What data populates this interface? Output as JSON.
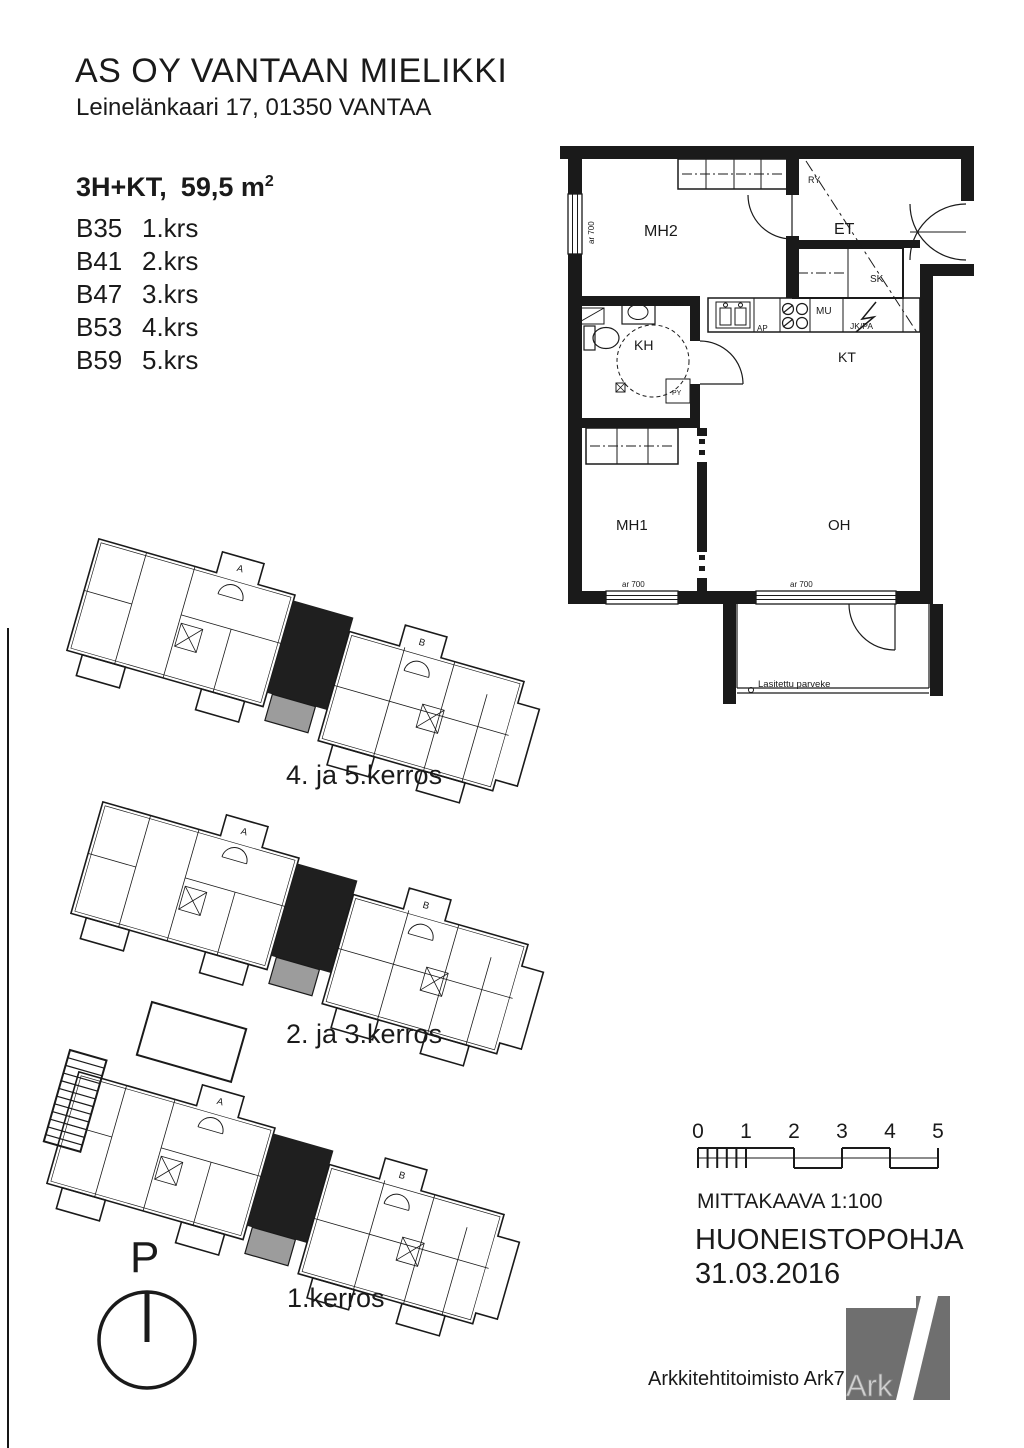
{
  "header": {
    "title": "AS OY VANTAAN MIELIKKI",
    "address": "Leinelänkaari 17, 01350  VANTAA"
  },
  "apartment": {
    "type": "3H+KT,",
    "area": "59,5 m",
    "area_sup": "2",
    "units": [
      {
        "id": "B35",
        "floor": "1.krs"
      },
      {
        "id": "B41",
        "floor": "2.krs"
      },
      {
        "id": "B47",
        "floor": "3.krs"
      },
      {
        "id": "B53",
        "floor": "4.krs"
      },
      {
        "id": "B59",
        "floor": "5.krs"
      }
    ]
  },
  "floorplan": {
    "rooms": {
      "mh2": "MH2",
      "et": "ET",
      "kh": "KH",
      "kt": "KT",
      "mh1": "MH1",
      "oh": "OH"
    },
    "fixtures": {
      "sk": "SK",
      "mu": "MU",
      "jk_pa": "JK/PA",
      "ap": "AP",
      "ppk_kr": "PPK/KR",
      "py": "PY",
      "ry": "RY"
    },
    "window_height": "ar 700",
    "balcony": "Lasitettu parveke"
  },
  "site_plans": {
    "stair_a": "A",
    "stair_b": "B",
    "captions": [
      "4. ja 5.kerros",
      "2. ja 3.kerros",
      "1.kerros"
    ]
  },
  "compass": {
    "north": "P"
  },
  "scale_bar": {
    "ticks": [
      "0",
      "1",
      "2",
      "3",
      "4",
      "5"
    ],
    "label": "MITTAKAAVA  1:100"
  },
  "titleblock": {
    "doc_type": "HUONEISTOPOHJA",
    "date": "31.03.2016",
    "firm": "Arkkitehtitoimisto Ark7 Oy",
    "logo_text": "Ark"
  },
  "colors": {
    "ink": "#1a1a1a",
    "highlight_unit": "#1f1f1f",
    "balcony_gray": "#9c9c9c",
    "logo_gray": "#6f6f6f"
  }
}
